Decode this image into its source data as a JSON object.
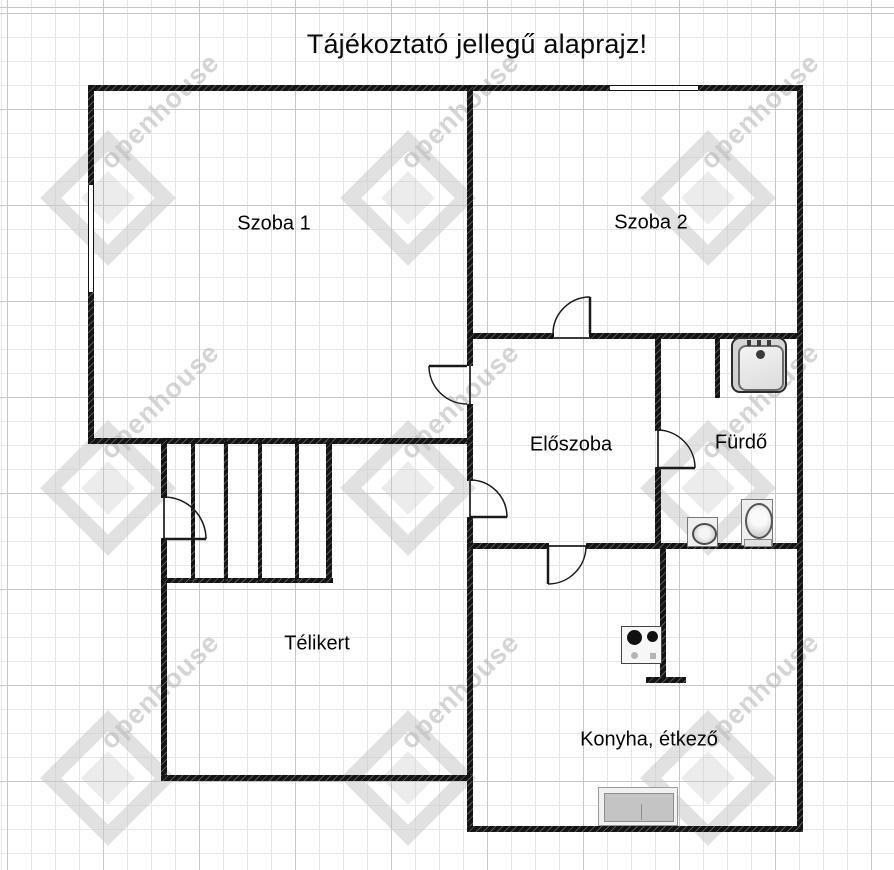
{
  "title": "Tájékoztató jellegű alaprajz!",
  "watermark_text": "openhouse",
  "rooms": {
    "szoba1": {
      "label": "Szoba 1"
    },
    "szoba2": {
      "label": "Szoba 2"
    },
    "eloszoba": {
      "label": "Előszoba"
    },
    "furdo": {
      "label": "Fürdő"
    },
    "telikert": {
      "label": "Télikert"
    },
    "konyha": {
      "label": "Konyha, étkező"
    }
  },
  "fixtures": {
    "shower": "shower-tray",
    "toilet": "toilet",
    "washbasin": "washbasin",
    "stove": "two-burner-cooktop",
    "counter": "kitchen-counter-with-sink",
    "stairs": "stairs"
  },
  "openings": {
    "doors": 6,
    "windows": 2
  },
  "colors": {
    "wall": "#141414",
    "grid_minor": "#e6e6e6",
    "grid_major": "#c6c6c6",
    "watermark": "#c9c9c9",
    "fixture_gray": "#cfcfcf"
  }
}
